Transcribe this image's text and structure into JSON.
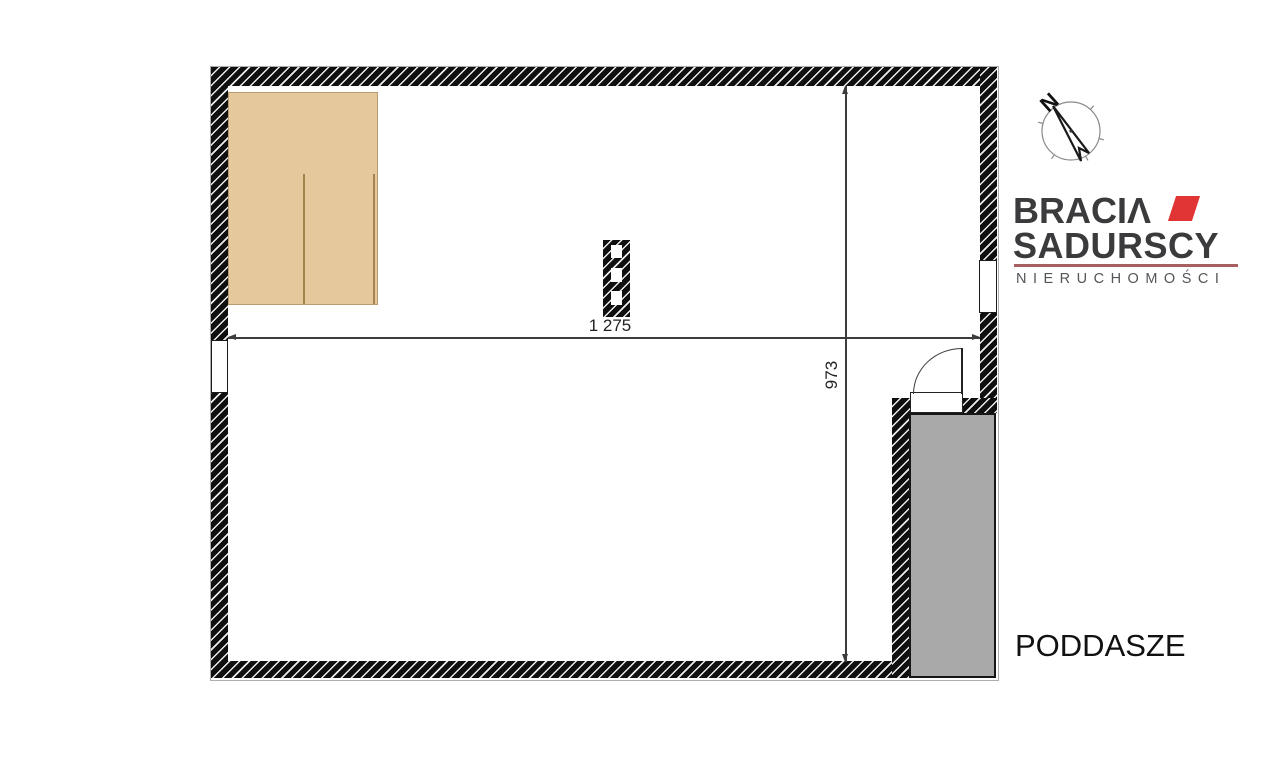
{
  "floor_plan": {
    "room_label": "PODDASZE",
    "dimension_horizontal": "1 275",
    "dimension_vertical": "973",
    "colors": {
      "wall": "#0f0f0f",
      "wardrobe_fill": "#e6c89d",
      "stairs_fill": "#a9a9a9",
      "dimension_line": "#3c3c3c"
    }
  },
  "compass": {
    "north_label": "N"
  },
  "brand": {
    "line1": "BRACIΛ",
    "line2": "SADURSCY",
    "tagline": "NIERUCHOMOŚCI",
    "colors": {
      "text": "#3b3b3d",
      "accent_red": "#e13434",
      "divider": "#a85f5f",
      "tagline_text": "#55555a"
    }
  }
}
